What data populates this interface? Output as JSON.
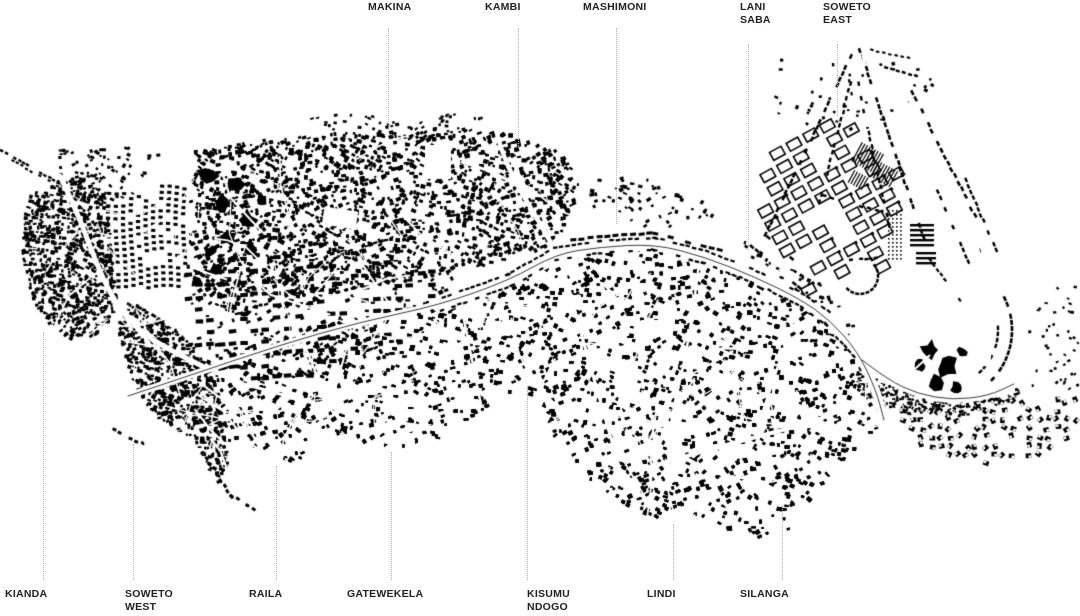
{
  "map": {
    "background_color": "#ffffff",
    "building_color": "#000000",
    "label_color": "#231f20",
    "leader_line_color": "#b3b3b3",
    "top_labels": [
      {
        "id": "makina",
        "lines": [
          "MAKINA"
        ]
      },
      {
        "id": "kambi",
        "lines": [
          "KAMBI"
        ]
      },
      {
        "id": "mashimoni",
        "lines": [
          "MASHIMONI"
        ]
      },
      {
        "id": "lani-saba",
        "lines": [
          "LANI",
          "SABA"
        ]
      },
      {
        "id": "soweto-east",
        "lines": [
          "SOWETO",
          "EAST"
        ]
      }
    ],
    "bottom_labels": [
      {
        "id": "kianda",
        "lines": [
          "KIANDA"
        ]
      },
      {
        "id": "soweto-west",
        "lines": [
          "SOWETO",
          "WEST"
        ]
      },
      {
        "id": "raila",
        "lines": [
          "RAILA"
        ]
      },
      {
        "id": "gatewekela",
        "lines": [
          "GATEWEKELA"
        ]
      },
      {
        "id": "kisumu-ndogo",
        "lines": [
          "KISUMU",
          "NDOGO"
        ]
      },
      {
        "id": "lindi",
        "lines": [
          "LINDI"
        ]
      },
      {
        "id": "silanga",
        "lines": [
          "SILANGA"
        ]
      }
    ]
  }
}
